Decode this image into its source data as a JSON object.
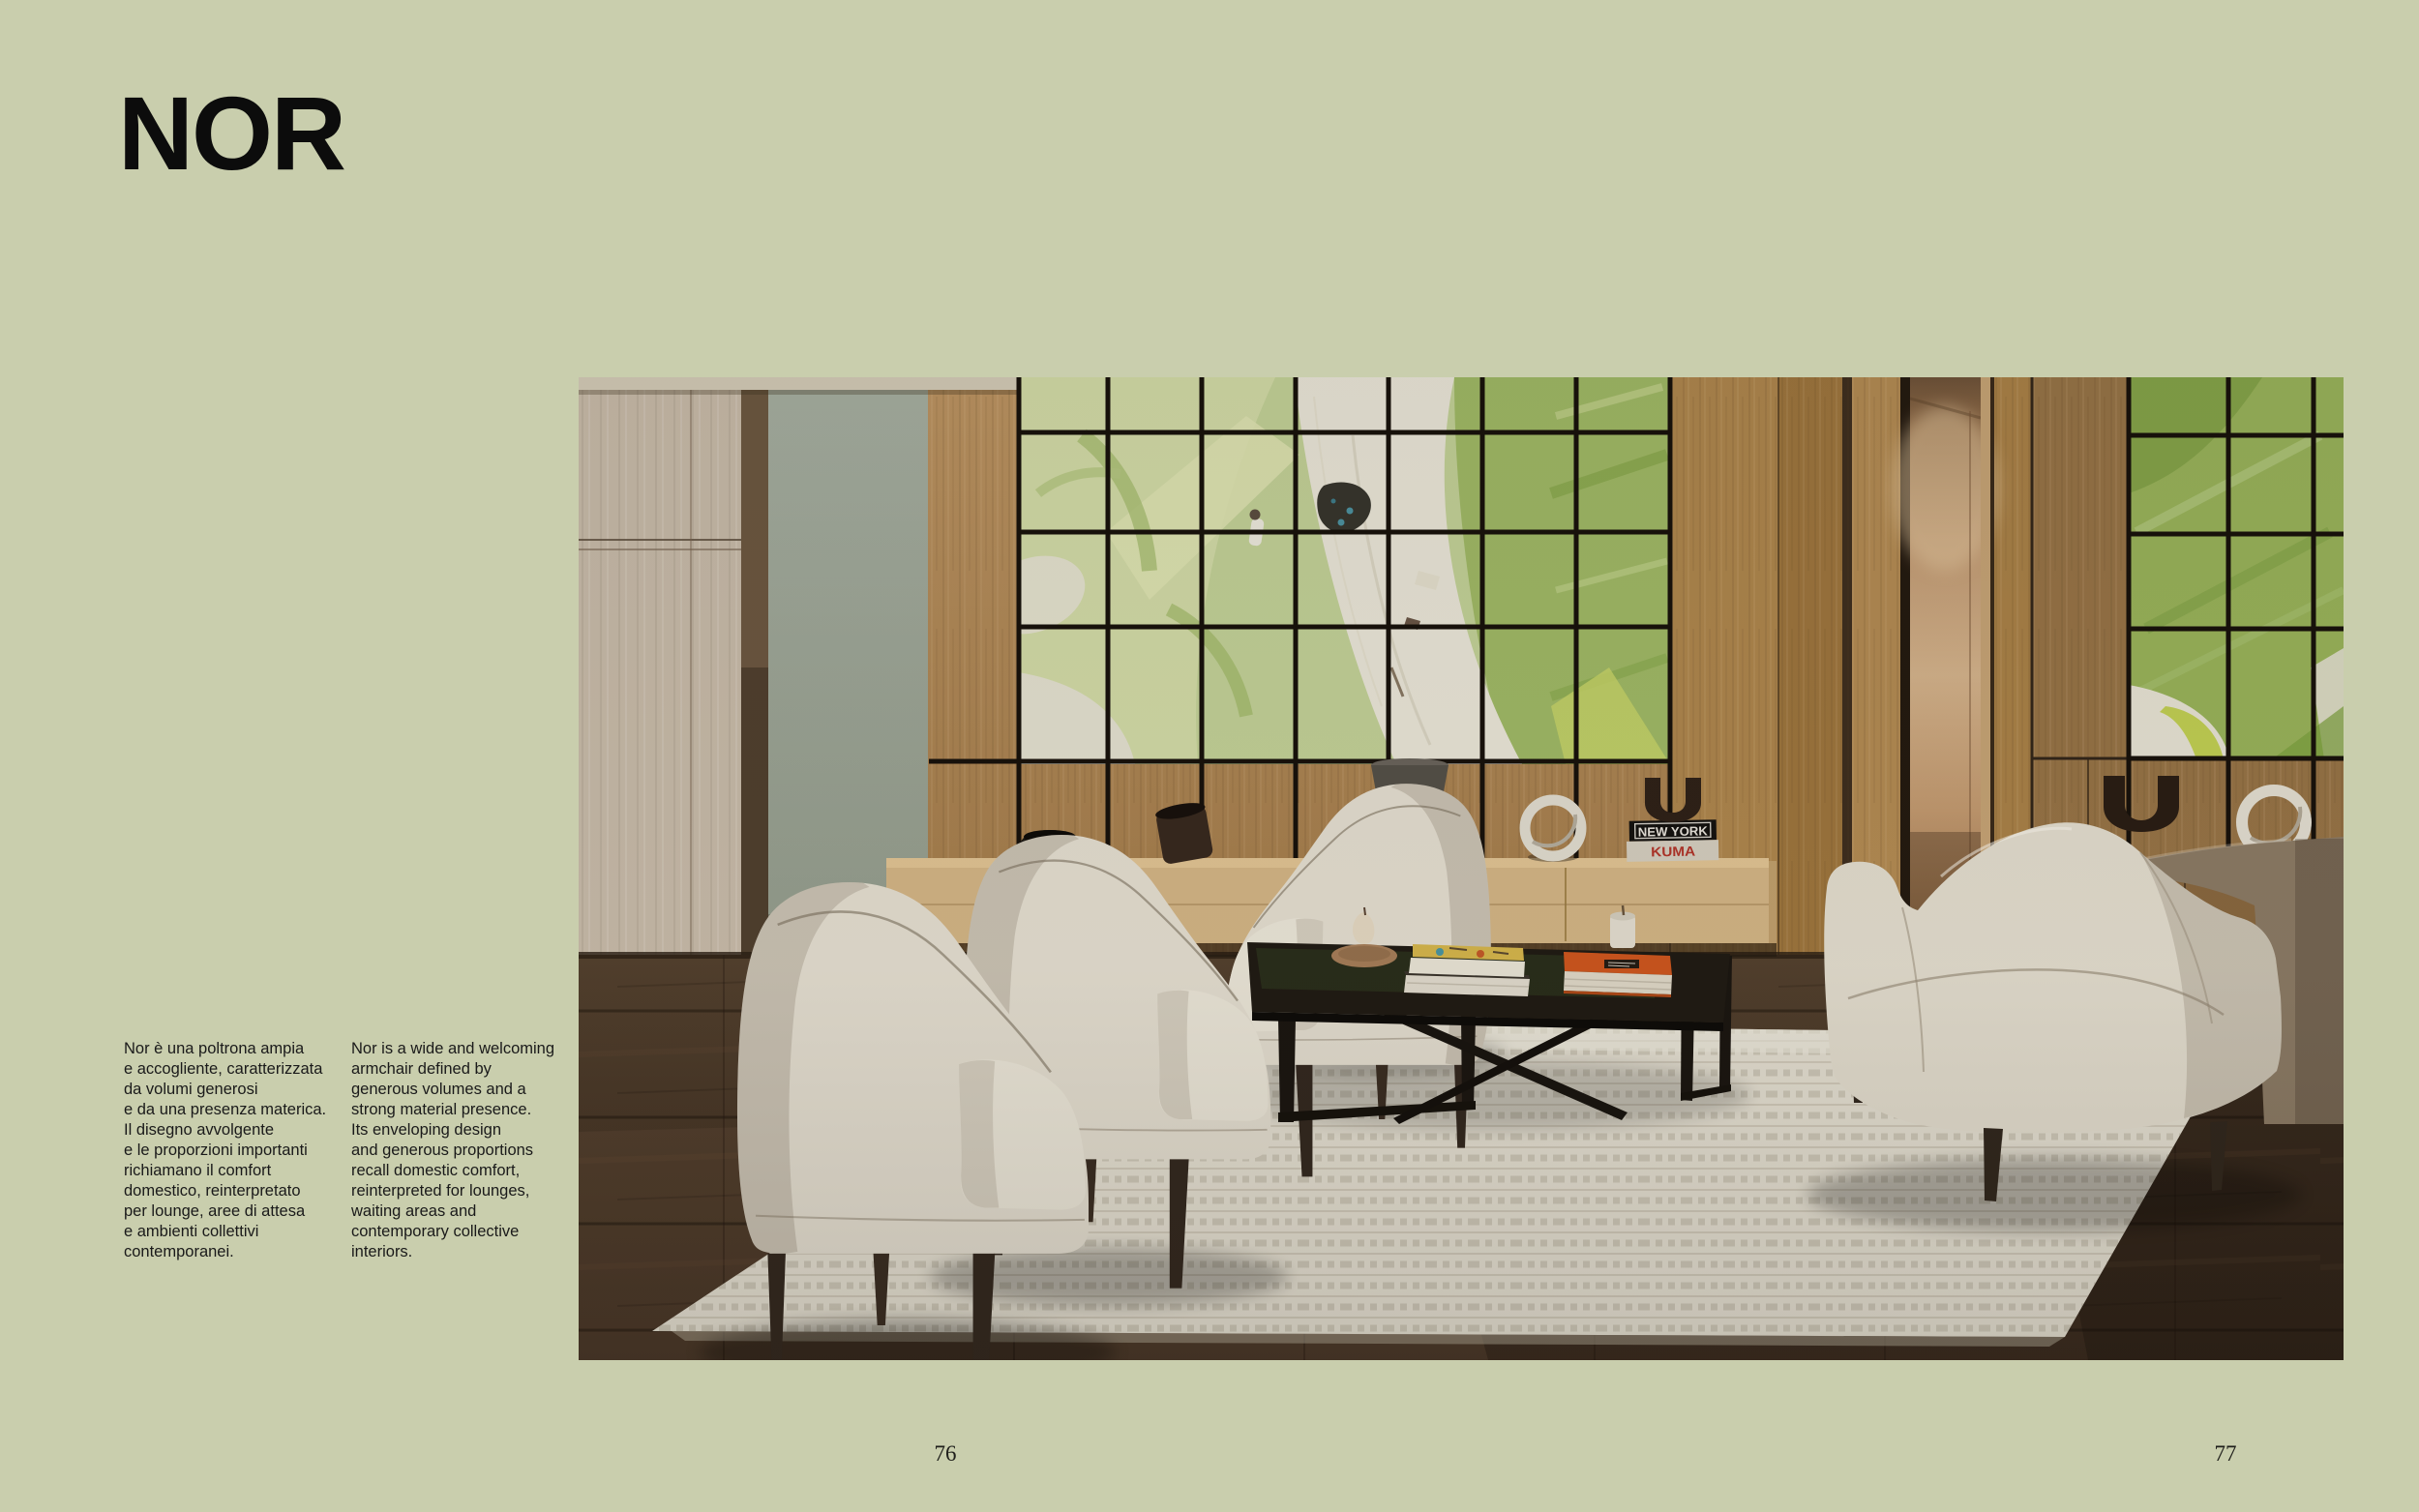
{
  "page": {
    "background_color": "#c9cead",
    "title": "NOR",
    "paragraph_it": "Nor è una poltrona ampia\ne accogliente, caratterizzata\nda volumi generosi\ne da una presenza materica.\nIl disegno avvolgente\ne le proporzioni importanti\nrichiamano il comfort\ndomestico, reinterpretato\nper lounge, aree di attesa\ne ambienti collettivi\ncontemporanei.",
    "paragraph_en": "Nor is a wide and welcoming\narmchair defined by\ngenerous volumes and a\nstrong material presence.\nIts enveloping design\nand generous proportions\nrecall domestic comfort,\nreinterpreted for lounges,\nwaiting areas and\ncontemporary collective\ninteriors.",
    "page_number_left": "76",
    "page_number_right": "77"
  },
  "photo": {
    "description": "Lounge interior with cream Nor armchairs, camelback sofa, dark coffee table with books, cream rug, oak wall paneling and a green abstract painting behind a black grid",
    "book_spine_top": "NEW YORK",
    "book_spine_bottom": "KUMA",
    "colors": {
      "wall_wood": "#b2894f",
      "art_green": "#a3bd68",
      "floor": "#4a392b",
      "upholstery": "#e9e3d5",
      "rug": "#e9e4d6",
      "accent_book_orange": "#d2581f",
      "table": "#201b14"
    }
  }
}
